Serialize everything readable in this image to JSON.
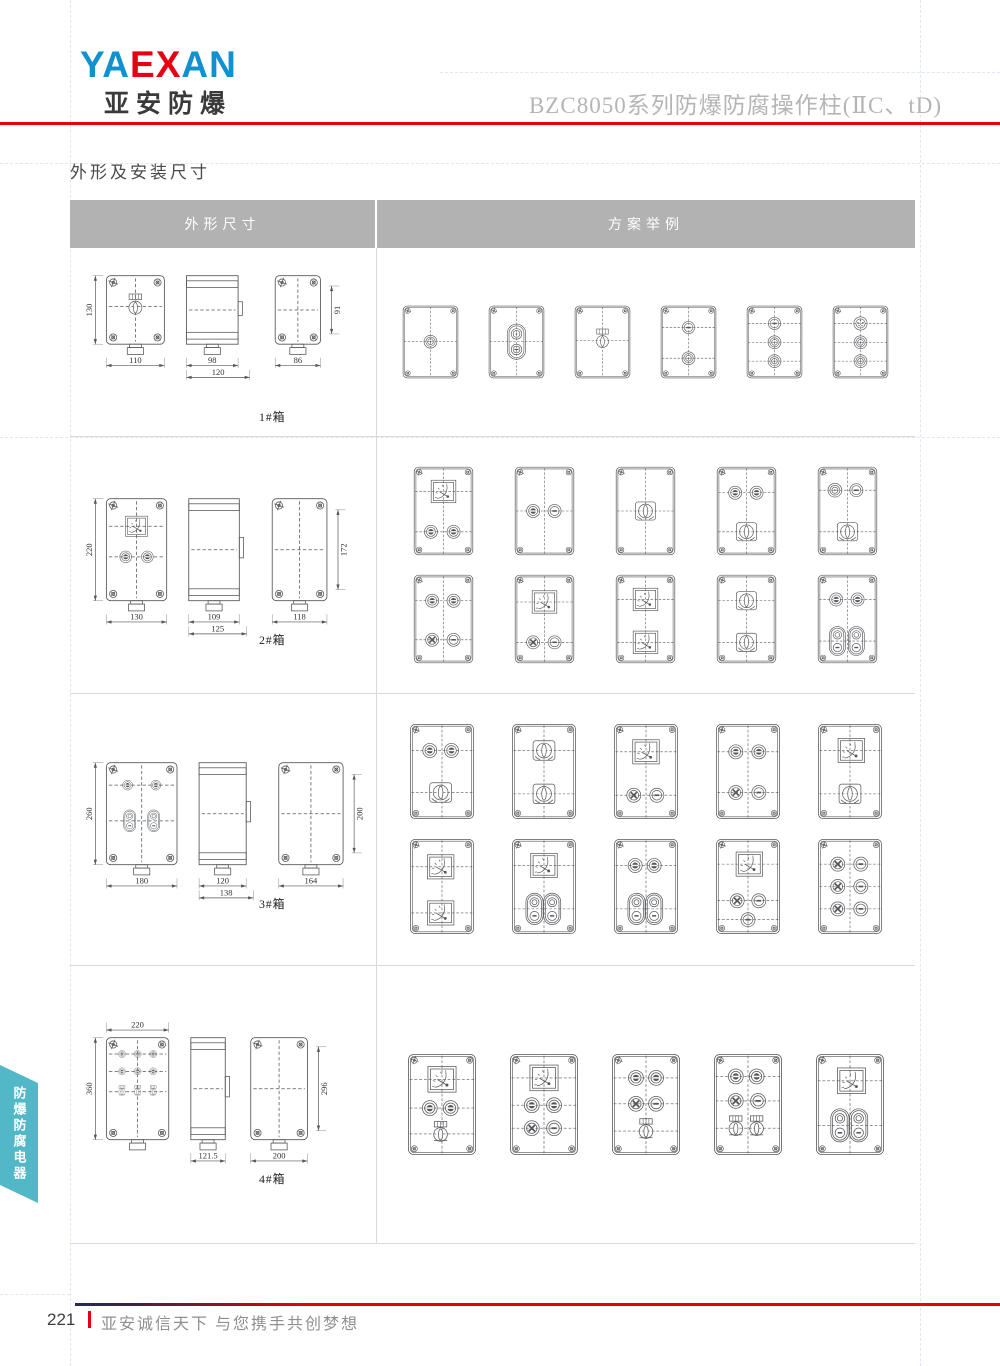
{
  "brand": {
    "logo": [
      {
        "text": "YA",
        "color": "#1291d0"
      },
      {
        "text": "EX",
        "color": "#e60012"
      },
      {
        "text": "AN",
        "color": "#1291d0"
      }
    ],
    "subtitle": "亚安防爆"
  },
  "header": {
    "doc_title": "BZC8050系列防爆防腐操作柱(ⅡC、tD)"
  },
  "section": {
    "title": "外形及安装尺寸"
  },
  "side_tab": {
    "label": "防爆防腐电器"
  },
  "footer": {
    "page_number": "221",
    "slogan": "亚安诚信天下 与您携手共创梦想"
  },
  "colors": {
    "accent_red": "#e60012",
    "brand_blue": "#1291d0",
    "tab_teal": "#52b7c6",
    "table_header_bg": "#b2b2b2",
    "line_ink": "#54565a",
    "title_gray": "#b5b5b5"
  },
  "table": {
    "headers": [
      "外形尺寸",
      "方案举例"
    ],
    "rows": [
      {
        "label": "1#箱",
        "dims": {
          "front_h": "130",
          "front_w": "110",
          "side_w1": "98",
          "side_w2": "120",
          "rear_w": "86",
          "rear_h": "91",
          "w_top": false
        },
        "front_parts": [
          [
            "keyknob",
            50,
            45
          ]
        ],
        "scheme_h": 129,
        "scheme_rows": [
          [
            [
              [
                "mushroom",
                50,
                64
              ]
            ],
            [
              [
                "dstack",
                50,
                64
              ]
            ],
            [
              [
                "keyknob",
                50,
                62
              ]
            ],
            [
              [
                "lamp",
                50,
                40
              ],
              [
                "mushroom",
                50,
                92
              ]
            ],
            [
              [
                "lamp",
                50,
                33
              ],
              [
                "mushroom",
                50,
                65
              ],
              [
                "mushroom",
                50,
                97
              ]
            ],
            [
              [
                "socket",
                50,
                33
              ],
              [
                "mushroom",
                50,
                65
              ],
              [
                "mushroom",
                50,
                97
              ]
            ]
          ]
        ]
      },
      {
        "label": "2#箱",
        "dims": {
          "front_h": "220",
          "front_w": "130",
          "side_w1": "109",
          "side_w2": "125",
          "rear_w": "118",
          "rear_h": "172",
          "w_top": false
        },
        "front_parts": [
          [
            "meter",
            50,
            27
          ],
          [
            "btn",
            32,
            57
          ],
          [
            "btn",
            68,
            57
          ]
        ],
        "scheme_h": 146,
        "scheme_rows": [
          [
            [
              [
                "meter",
                50,
                42
              ],
              [
                "btn",
                30,
                106
              ],
              [
                "btn",
                66,
                106
              ]
            ],
            [
              [
                "btn",
                32,
                73
              ],
              [
                "lamp",
                66,
                73
              ]
            ],
            [
              [
                "knob",
                50,
                73
              ]
            ],
            [
              [
                "btn",
                32,
                44
              ],
              [
                "btn",
                66,
                44
              ],
              [
                "knob",
                50,
                106
              ]
            ],
            [
              [
                "mushroom",
                30,
                40
              ],
              [
                "lamp",
                64,
                40
              ],
              [
                "knob",
                50,
                106
              ]
            ]
          ],
          [
            [
              [
                "btn",
                32,
                44
              ],
              [
                "btn",
                66,
                44
              ],
              [
                "xlamp",
                32,
                106
              ],
              [
                "lamp",
                66,
                106
              ]
            ],
            [
              [
                "meter",
                50,
                46
              ],
              [
                "xlamp",
                32,
                110
              ],
              [
                "lamp",
                66,
                110
              ]
            ],
            [
              [
                "meter",
                50,
                42
              ],
              [
                "meter",
                50,
                110
              ]
            ],
            [
              [
                "knob",
                50,
                44
              ],
              [
                "knob",
                50,
                110
              ]
            ],
            [
              [
                "btn",
                32,
                42
              ],
              [
                "btn",
                66,
                42
              ],
              [
                "dlamp",
                34,
                108
              ],
              [
                "dlamp",
                64,
                108
              ]
            ]
          ]
        ]
      },
      {
        "label": "3#箱",
        "dims": {
          "front_h": "260",
          "front_w": "180",
          "side_w1": "120",
          "side_w2": "138",
          "rear_w": "164",
          "rear_h": "200",
          "w_top": false
        },
        "front_parts": [
          [
            "btn",
            30,
            22
          ],
          [
            "btn",
            70,
            22
          ],
          [
            "dlamp",
            33,
            57
          ],
          [
            "dlamp",
            67,
            57
          ]
        ],
        "scheme_h": 146,
        "scheme_rows": [
          [
            [
              [
                "btn",
                32,
                42
              ],
              [
                "btn",
                64,
                42
              ],
              [
                "knob",
                48,
                104
              ]
            ],
            [
              [
                "knob",
                50,
                42
              ],
              [
                "knob",
                50,
                106
              ]
            ],
            [
              [
                "meter",
                50,
                44
              ],
              [
                "xlamp",
                32,
                108
              ],
              [
                "lamp",
                66,
                108
              ]
            ],
            [
              [
                "btn",
                32,
                44
              ],
              [
                "btn",
                66,
                44
              ],
              [
                "xlamp",
                32,
                104
              ],
              [
                "lamp",
                66,
                104
              ]
            ],
            [
              [
                "meter",
                52,
                42
              ],
              [
                "knob",
                50,
                106
              ]
            ]
          ],
          [
            [
              [
                "meter",
                48,
                44
              ],
              [
                "meter",
                48,
                112
              ]
            ],
            [
              [
                "meter",
                50,
                42
              ],
              [
                "dlamp",
                36,
                106
              ],
              [
                "dlamp",
                62,
                106
              ]
            ],
            [
              [
                "btn",
                34,
                42
              ],
              [
                "btn",
                62,
                42
              ],
              [
                "dlamp",
                36,
                106
              ],
              [
                "dlamp",
                62,
                106
              ]
            ],
            [
              [
                "meter",
                52,
                40
              ],
              [
                "xlamp",
                34,
                94
              ],
              [
                "lamp",
                66,
                94
              ],
              [
                "lamp",
                50,
                122
              ]
            ],
            [
              [
                "xlamp",
                32,
                40
              ],
              [
                "lamp",
                66,
                40
              ],
              [
                "xlamp",
                32,
                73
              ],
              [
                "lamp",
                66,
                73
              ],
              [
                "xlamp",
                32,
                106
              ],
              [
                "lamp",
                66,
                106
              ]
            ]
          ]
        ]
      },
      {
        "label": "4#箱",
        "dims": {
          "front_h": "360",
          "front_w": "220",
          "side_w1": "121.5",
          "side_w2": null,
          "rear_w": "200",
          "rear_h": "296",
          "w_top": true
        },
        "front_parts": [
          [
            "btn",
            25,
            16
          ],
          [
            "btn",
            50,
            16
          ],
          [
            "btn",
            75,
            16
          ],
          [
            "btn",
            25,
            33
          ],
          [
            "btn",
            50,
            33
          ],
          [
            "btn",
            75,
            33
          ],
          [
            "hswitch",
            25,
            53
          ],
          [
            "hswitch",
            50,
            53
          ],
          [
            "hswitch",
            75,
            53
          ]
        ],
        "scheme_h": 146,
        "scheme_rows": [
          [
            [
              [
                "meter",
                50,
                38
              ],
              [
                "btn",
                33,
                78
              ],
              [
                "btn",
                62,
                78
              ],
              [
                "hswitch",
                48,
                114
              ]
            ],
            [
              [
                "meter",
                50,
                36
              ],
              [
                "btn",
                33,
                74
              ],
              [
                "btn",
                64,
                74
              ],
              [
                "xlamp",
                33,
                106
              ],
              [
                "lamp",
                64,
                106
              ]
            ],
            [
              [
                "btn",
                36,
                36
              ],
              [
                "btn",
                64,
                36
              ],
              [
                "xlamp",
                36,
                72
              ],
              [
                "lamp",
                64,
                72
              ],
              [
                "hswitch",
                50,
                110
              ]
            ],
            [
              [
                "btn",
                33,
                34
              ],
              [
                "btn",
                62,
                34
              ],
              [
                "xlamp",
                33,
                68
              ],
              [
                "lamp",
                64,
                68
              ],
              [
                "hswitch",
                33,
                106
              ],
              [
                "hswitch",
                62,
                106
              ]
            ],
            [
              [
                "meter",
                52,
                40
              ],
              [
                "dlamp",
                36,
                102
              ],
              [
                "dlamp",
                62,
                102
              ]
            ]
          ]
        ]
      }
    ]
  }
}
